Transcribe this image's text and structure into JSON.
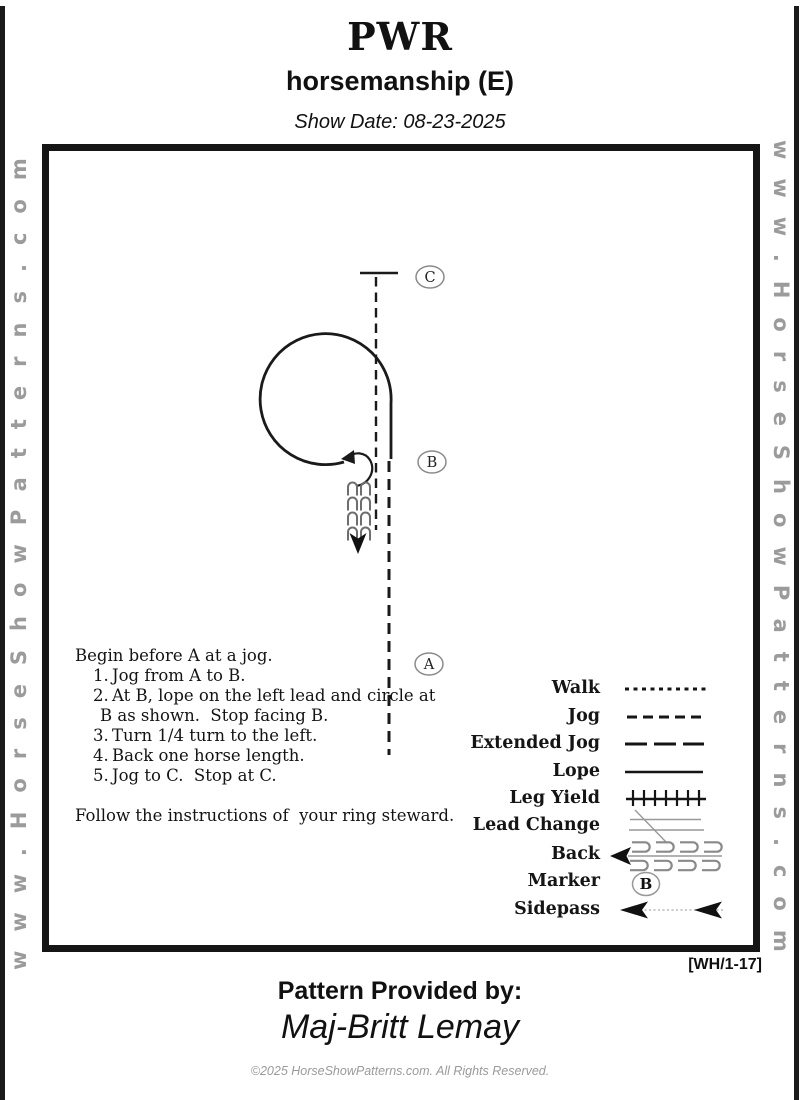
{
  "header": {
    "title": "PWR",
    "subtitle": "horsemanship (E)",
    "show_date": "Show Date: 08-23-2025"
  },
  "watermark": {
    "left": "www.HorseShowPatterns.com",
    "right": "www.HorseShowPatterns.com"
  },
  "diagram": {
    "markers": {
      "a": "A",
      "b": "B",
      "c": "C"
    }
  },
  "instructions": {
    "intro": "Begin before A at a jog.",
    "items": [
      {
        "num": "1.",
        "text": "Jog from A to B."
      },
      {
        "num": "2.",
        "text": "At B, lope on the left lead and circle at",
        "text2": "B as shown.  Stop facing B."
      },
      {
        "num": "3.",
        "text": "Turn 1/4 turn to the left."
      },
      {
        "num": "4.",
        "text": "Back one horse length."
      },
      {
        "num": "5.",
        "text": "Jog to C.  Stop at C."
      }
    ],
    "footer": "Follow the instructions of  your ring steward."
  },
  "legend": {
    "items": [
      {
        "label": "Walk"
      },
      {
        "label": "Jog"
      },
      {
        "label": "Extended Jog"
      },
      {
        "label": "Lope"
      },
      {
        "label": "Leg Yield"
      },
      {
        "label": "Lead Change"
      },
      {
        "label": "Back"
      },
      {
        "label": "Marker"
      },
      {
        "label": "Sidepass"
      }
    ],
    "marker_letter": "B"
  },
  "footer": {
    "code": "[WH/1-17]",
    "provided_label": "Pattern Provided by:",
    "provider": "Maj-Britt Lemay",
    "copyright": "©2025 HorseShowPatterns.com. All Rights Reserved."
  },
  "colors": {
    "ink": "#1a1a1a",
    "watermark_gray": "#9b9b9b",
    "symbol_gray": "#8a8a8a"
  }
}
